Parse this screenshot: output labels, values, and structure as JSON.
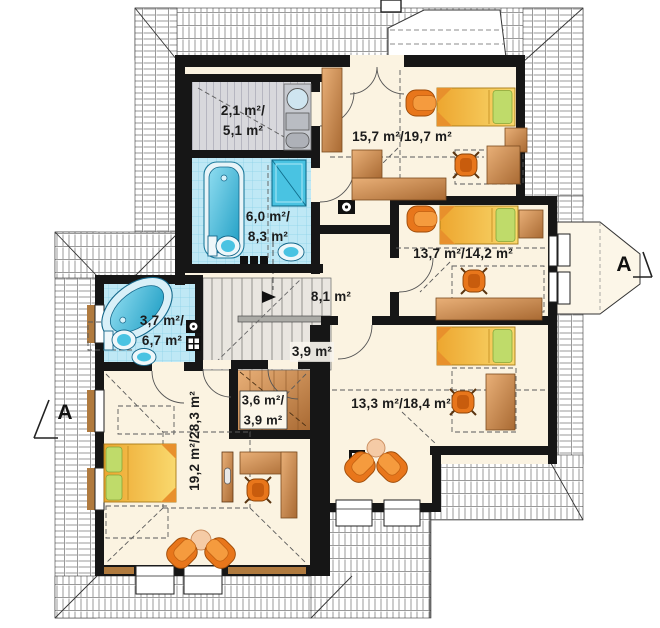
{
  "rooms": [
    {
      "name": "wardrobe-top",
      "lines": [
        "2,1 m²/",
        "5,1 m²"
      ]
    },
    {
      "name": "bedroom-top-right",
      "lines": [
        "15,7 m²/19,7 m²"
      ]
    },
    {
      "name": "bathroom-main",
      "lines": [
        "6,0 m²/",
        "8,3 m²"
      ]
    },
    {
      "name": "bedroom-right",
      "lines": [
        "13,7 m²/14,2 m²"
      ]
    },
    {
      "name": "hall",
      "lines": [
        "8,1 m²"
      ]
    },
    {
      "name": "bathroom-left",
      "lines": [
        "3,7 m²/",
        "6,7 m²"
      ]
    },
    {
      "name": "staircase",
      "lines": [
        "3,9 m²"
      ]
    },
    {
      "name": "closet-small",
      "lines": [
        "3,6 m²/",
        "3,9 m²"
      ]
    },
    {
      "name": "bedroom-bottom-right",
      "lines": [
        "13,3 m²/18,4 m²"
      ]
    },
    {
      "name": "master-bedroom",
      "lines": [
        "19,2 m²/28,3 m²"
      ]
    }
  ],
  "section_markers": {
    "left": "A",
    "right": "A"
  },
  "colors": {
    "wall": "#161616",
    "floor": "#fbf3e1",
    "tile": "#bfe8f5",
    "fixture_blue": "#3fc3e0",
    "wood": "#c9854b",
    "bed_yellow": "#f4c24d",
    "pillow_green": "#b8d768",
    "armchair_orange": "#ee8423",
    "stair_gray": "#e9e6e0",
    "closet_gray": "#d8d8dc"
  }
}
